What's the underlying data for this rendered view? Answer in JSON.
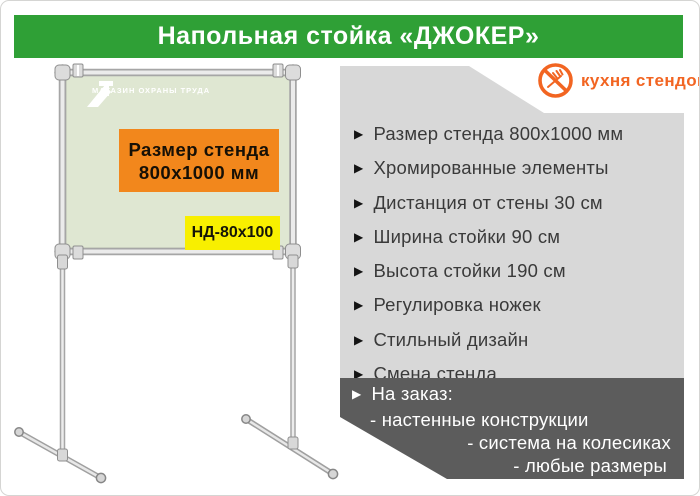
{
  "header": {
    "title": "Напольная стойка «ДЖОКЕР»"
  },
  "brand": {
    "name": "кухня стендов"
  },
  "stand": {
    "board_logo": "МАГАЗИН ОХРАНЫ ТРУДА",
    "size_line1": "Размер стенда",
    "size_line2": "800x1000  мм",
    "model": "НД-80x100"
  },
  "features": [
    "Размер стенда 800х1000 мм",
    "Хромированные элементы",
    "Дистанция от стены 30 см",
    "Ширина стойки 90 см",
    "Высота стойки 190 см",
    "Регулировка ножек",
    "Стильный дизайн",
    "Смена стенда"
  ],
  "custom_order": {
    "title": "На заказ:",
    "items": [
      "- настенные конструкции",
      "- система на колесиках",
      "- любые размеры"
    ]
  },
  "colors": {
    "header_green": "#2fa036",
    "brand_orange": "#f26522",
    "size_box_orange": "#f2871c",
    "model_yellow": "#f8ef00",
    "board_green": "#dfe7d2",
    "panel_gray": "#d8d8d8",
    "panel_dark": "#5c5c5c"
  }
}
